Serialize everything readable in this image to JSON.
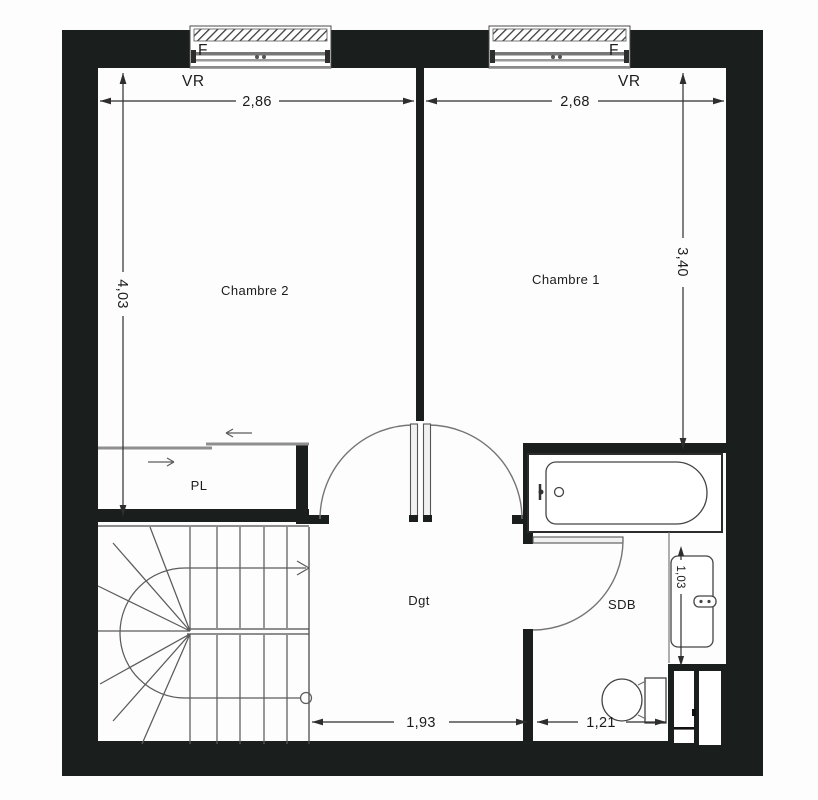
{
  "plan": {
    "rooms": {
      "chambre2": "Chambre 2",
      "chambre1": "Chambre 1",
      "degagement": "Dgt",
      "salle_de_bains": "SDB",
      "placard": "PL"
    },
    "windows": {
      "left": {
        "type": "F",
        "shutter": "VR"
      },
      "right": {
        "type": "F",
        "shutter": "VR"
      }
    },
    "dimensions": {
      "chambre2_width": "2,86",
      "chambre1_width": "2,68",
      "chambre2_depth": "4,03",
      "chambre1_depth": "3,40",
      "sdb_depth": "1,03",
      "dgt_width": "1,93",
      "sdb_width": "1,21"
    },
    "colors": {
      "wall": "#1a1e1d",
      "line": "#4c4c4c",
      "dim": "#2e2e2e",
      "text": "#1c1c1c",
      "background": "#fdfdfd"
    }
  }
}
